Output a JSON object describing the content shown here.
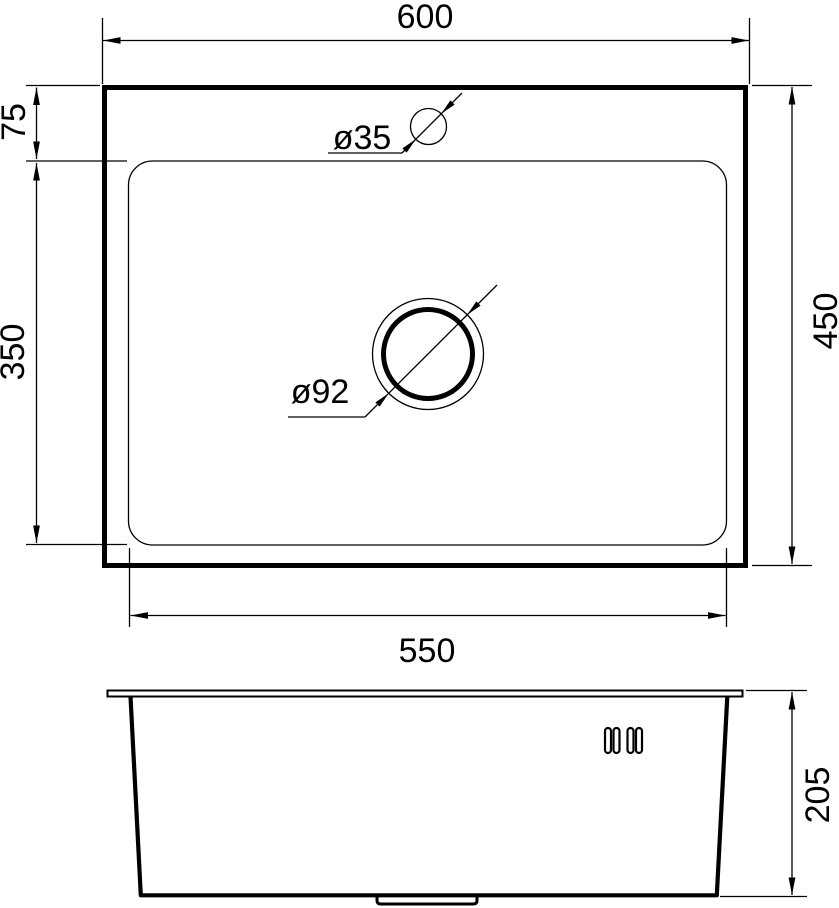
{
  "diagram": {
    "subject": "Kitchen sink technical dimension drawing, top view and side view",
    "background": "#ffffff",
    "stroke_color": "#000000",
    "top_view": {
      "width_label": "600",
      "depth_label": "450",
      "inner_width_label": "550",
      "top_offset_label": "75",
      "bowl_depth_label": "350",
      "faucet_hole_label": "ø35",
      "drain_hole_label": "ø92"
    },
    "side_view": {
      "height_label": "205"
    }
  }
}
